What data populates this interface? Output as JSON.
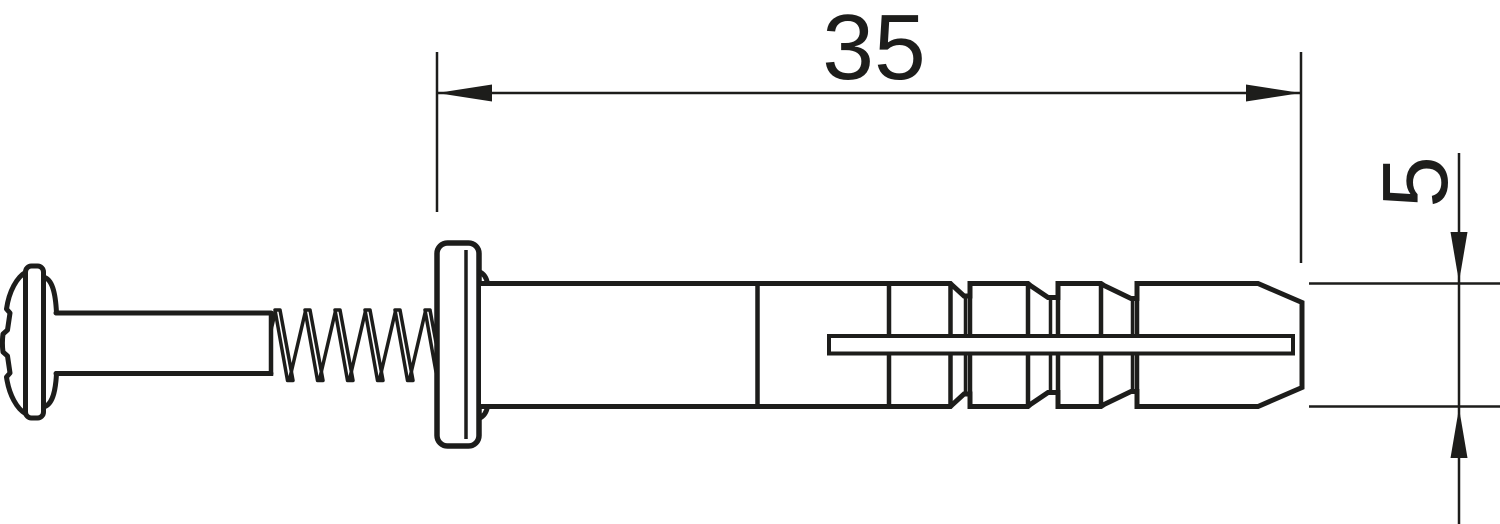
{
  "drawing": {
    "type": "technical-dimension-drawing",
    "subject": "hammer-drive anchor with pan-head screw, side view",
    "colors": {
      "line": "#1d1d1b",
      "background": "#ffffff"
    },
    "dimensions": {
      "length": {
        "value": "35",
        "orientation": "horizontal"
      },
      "diameter": {
        "value": "5",
        "orientation": "vertical-rotated"
      }
    }
  }
}
